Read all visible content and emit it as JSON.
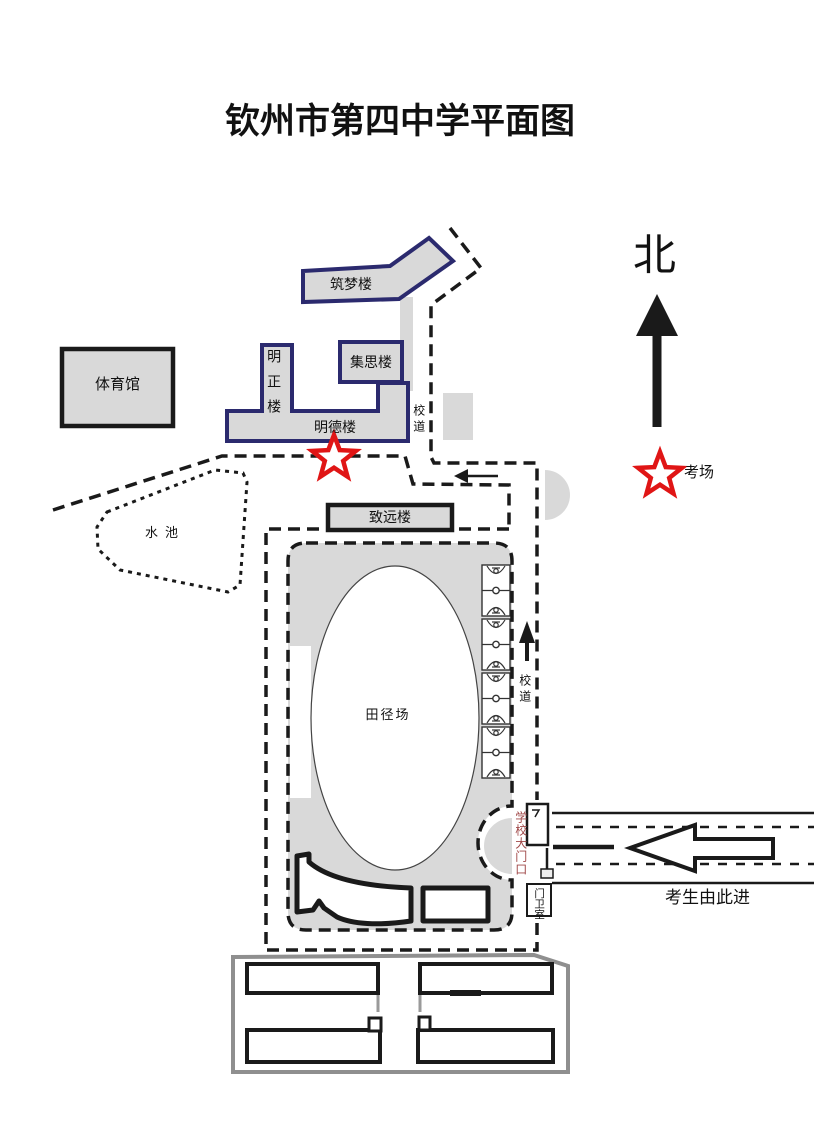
{
  "title": "钦州市第四中学平面图",
  "compass": {
    "north_label": "北"
  },
  "legend": {
    "exam_site_label": "考场"
  },
  "buildings": {
    "gymnasium": "体育馆",
    "zhumeng_building": "筑梦楼",
    "mingzheng_building": "明正楼",
    "jisi_building": "集思楼",
    "mingde_building": "明德楼",
    "zhiyuan_building": "致远楼"
  },
  "areas": {
    "pond": "水池",
    "athletic_field": "田径场"
  },
  "roads": {
    "campus_road_upper": "校道",
    "campus_road_lower": "校道"
  },
  "gate": {
    "main_gate_label": "学校大门口",
    "guard_room_label": "门卫室",
    "entry_direction": "考生由此进"
  },
  "colors": {
    "navy": "#2b2a6e",
    "fill_gray": "#d9d9d9",
    "line_black": "#1a1a1a",
    "boundary_gray": "#8f8f8f",
    "star_red": "#e01515",
    "gate_text_red": "#a04848"
  }
}
